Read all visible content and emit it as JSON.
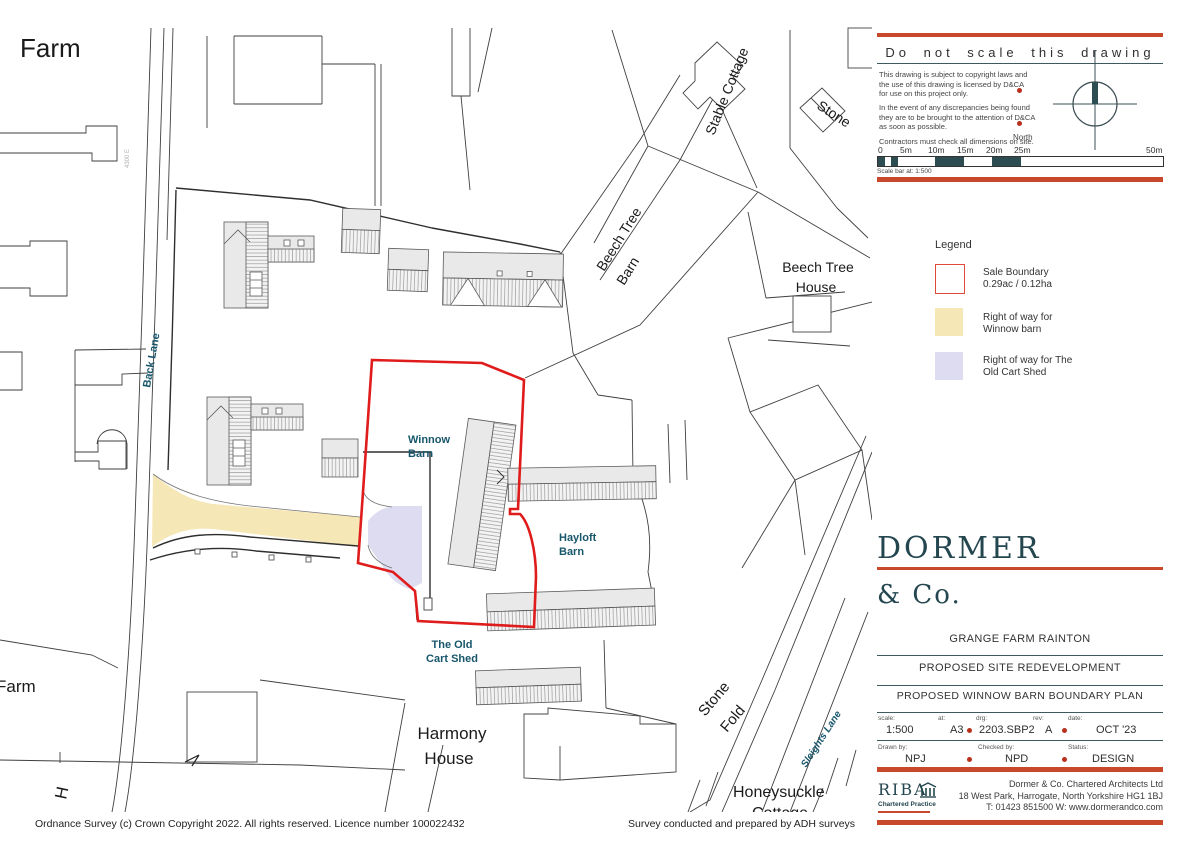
{
  "colors": {
    "accent_orange": "#c8482b",
    "panel_rule": "#3e5a60",
    "brand_teal": "#24464f",
    "map_label_teal": "#17566b",
    "sale_boundary_red": "#e01b1b",
    "right_of_way_yellow": "#f6e7b6",
    "right_of_way_lavender": "#dedcf0",
    "compass_needle": "#2e4d52"
  },
  "info_box": {
    "title": "Do not scale this drawing",
    "note1_l1": "This drawing is subject to copyright laws and",
    "note1_l2": "the use of this drawing is licensed by D&CA",
    "note1_l3": "for use on this project only.",
    "note2_l1": "In the event of any discrepancies being found",
    "note2_l2": "they are to be brought to the attention of D&CA",
    "note2_l3": "as soon as possible.",
    "note3": "Contractors must check all dimensions on site.",
    "north": "North",
    "scale_ticks": [
      "0",
      "5m",
      "10m",
      "15m",
      "20m",
      "25m",
      "50m"
    ],
    "scale_caption": "Scale bar at: 1:500"
  },
  "legend": {
    "title": "Legend",
    "items": [
      {
        "name": "sale-boundary",
        "line1": "Sale Boundary",
        "line2": "0.29ac / 0.12ha"
      },
      {
        "name": "row-winnow-barn",
        "line1": "Right of way for",
        "line2": "Winnow barn"
      },
      {
        "name": "row-old-cart-shed",
        "line1": "Right of way for The",
        "line2": "Old Cart Shed"
      }
    ]
  },
  "brand": {
    "name": "DORMER",
    "suffix": "& Co."
  },
  "title_block": {
    "project": "GRANGE FARM RAINTON",
    "scheme": "PROPOSED SITE REDEVELOPMENT",
    "drawing": "PROPOSED WINNOW BARN BOUNDARY PLAN",
    "scale_label": "scale:",
    "scale": "1:500",
    "at_label": "at:",
    "at": "A3",
    "drg_label": "drg:",
    "drg": "2203.SBP2",
    "rev_label": "rev:",
    "rev": "A",
    "date_label": "date:",
    "date": "OCT '23",
    "drawn_label": "Drawn by:",
    "drawn": "NPJ",
    "checked_label": "Checked by:",
    "checked": "NPD",
    "status_label": "Status:",
    "status": "DESIGN"
  },
  "firm": {
    "riba": "RIBA",
    "riba_sub": "Chartered Practice",
    "name": "Dormer & Co. Chartered Architects Ltd",
    "address": "18 West Park, Harrogate, North Yorkshire  HG1 1BJ",
    "contact": "T: 01423 851500   W: www.dormerandco.com"
  },
  "credits": {
    "os": "Ordnance Survey (c) Crown Copyright 2022. All rights reserved. Licence number 100022432",
    "survey": "Survey conducted and prepared by ADH surveys"
  },
  "map": {
    "labels": {
      "farm_top": "Farm",
      "farm_left": "Farm",
      "h_partial": "H",
      "back_lane": "Back Lane",
      "grid_ref": "4300 E",
      "stable_cottage": "Stable Cottage",
      "stone_partial": "Stone",
      "beech_tree_barn_1": "Beech Tree",
      "beech_tree_barn_2": "Barn",
      "beech_tree_house_1": "Beech Tree",
      "beech_tree_house_2": "House",
      "winnow_1": "Winnow",
      "winnow_2": "Barn",
      "hayloft_1": "Hayloft",
      "hayloft_2": "Barn",
      "cart_shed_1": "The Old",
      "cart_shed_2": "Cart Shed",
      "harmony_1": "Harmony",
      "harmony_2": "House",
      "stone_fold_1": "Stone",
      "stone_fold_2": "Fold",
      "sleights_lane": "Sleights Lane",
      "honeysuckle_1": "Honeysuckle",
      "honeysuckle_2": "Cottage"
    }
  }
}
